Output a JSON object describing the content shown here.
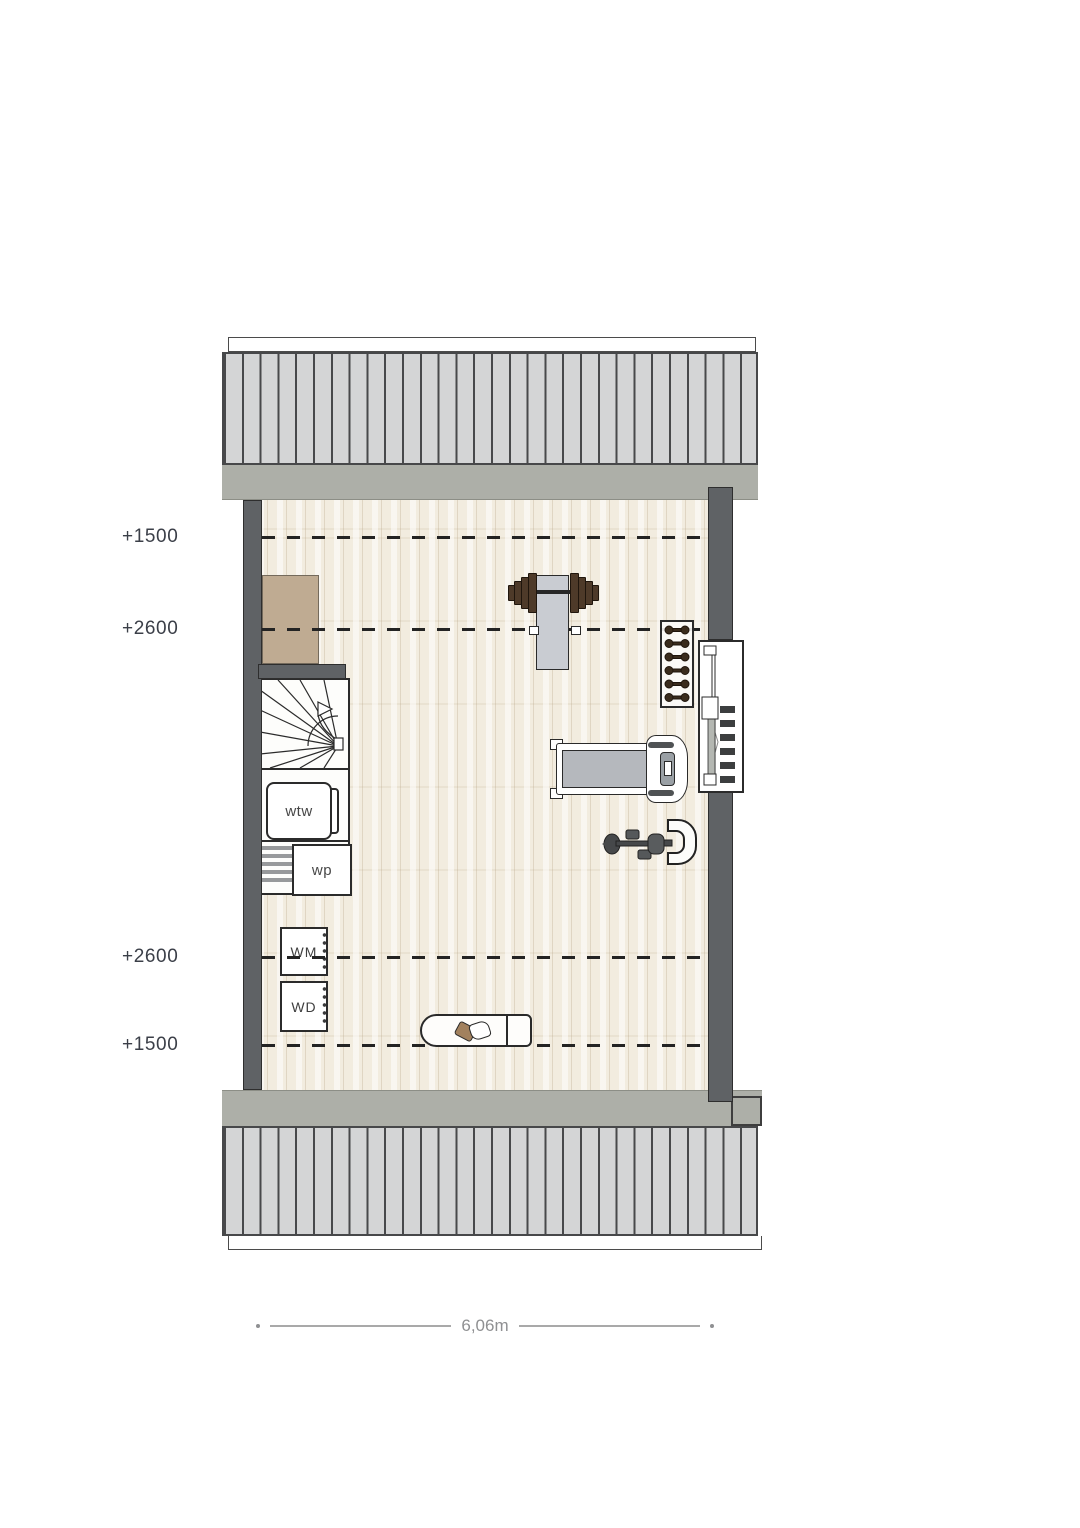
{
  "floorplan": {
    "elevation_markers": [
      {
        "label": "+1500"
      },
      {
        "label": "+2600"
      },
      {
        "label": "+2600"
      },
      {
        "label": "+1500"
      }
    ],
    "units": {
      "wtw": {
        "label": "wtw"
      },
      "wp": {
        "label": "wp"
      },
      "washing_machine": {
        "label": "WM"
      },
      "dryer": {
        "label": "WD"
      }
    },
    "dimension": {
      "label": "6,06m"
    },
    "equipment": [
      {
        "name": "barbell-bench"
      },
      {
        "name": "dumbbell-rack"
      },
      {
        "name": "treadmill"
      },
      {
        "name": "exercise-bike"
      },
      {
        "name": "surfboard"
      }
    ],
    "colors": {
      "wall": "#5f6265",
      "roof_band": "#adafa8",
      "roof_stripe": "#d4d5d6",
      "floor_base": "#f2ecdf",
      "closet": "#bfab92",
      "marker_text": "#3b3f48",
      "dimension_text": "#8f9092",
      "line_dark": "#2b2b2b",
      "weight_brown": "#4e3a29"
    }
  }
}
